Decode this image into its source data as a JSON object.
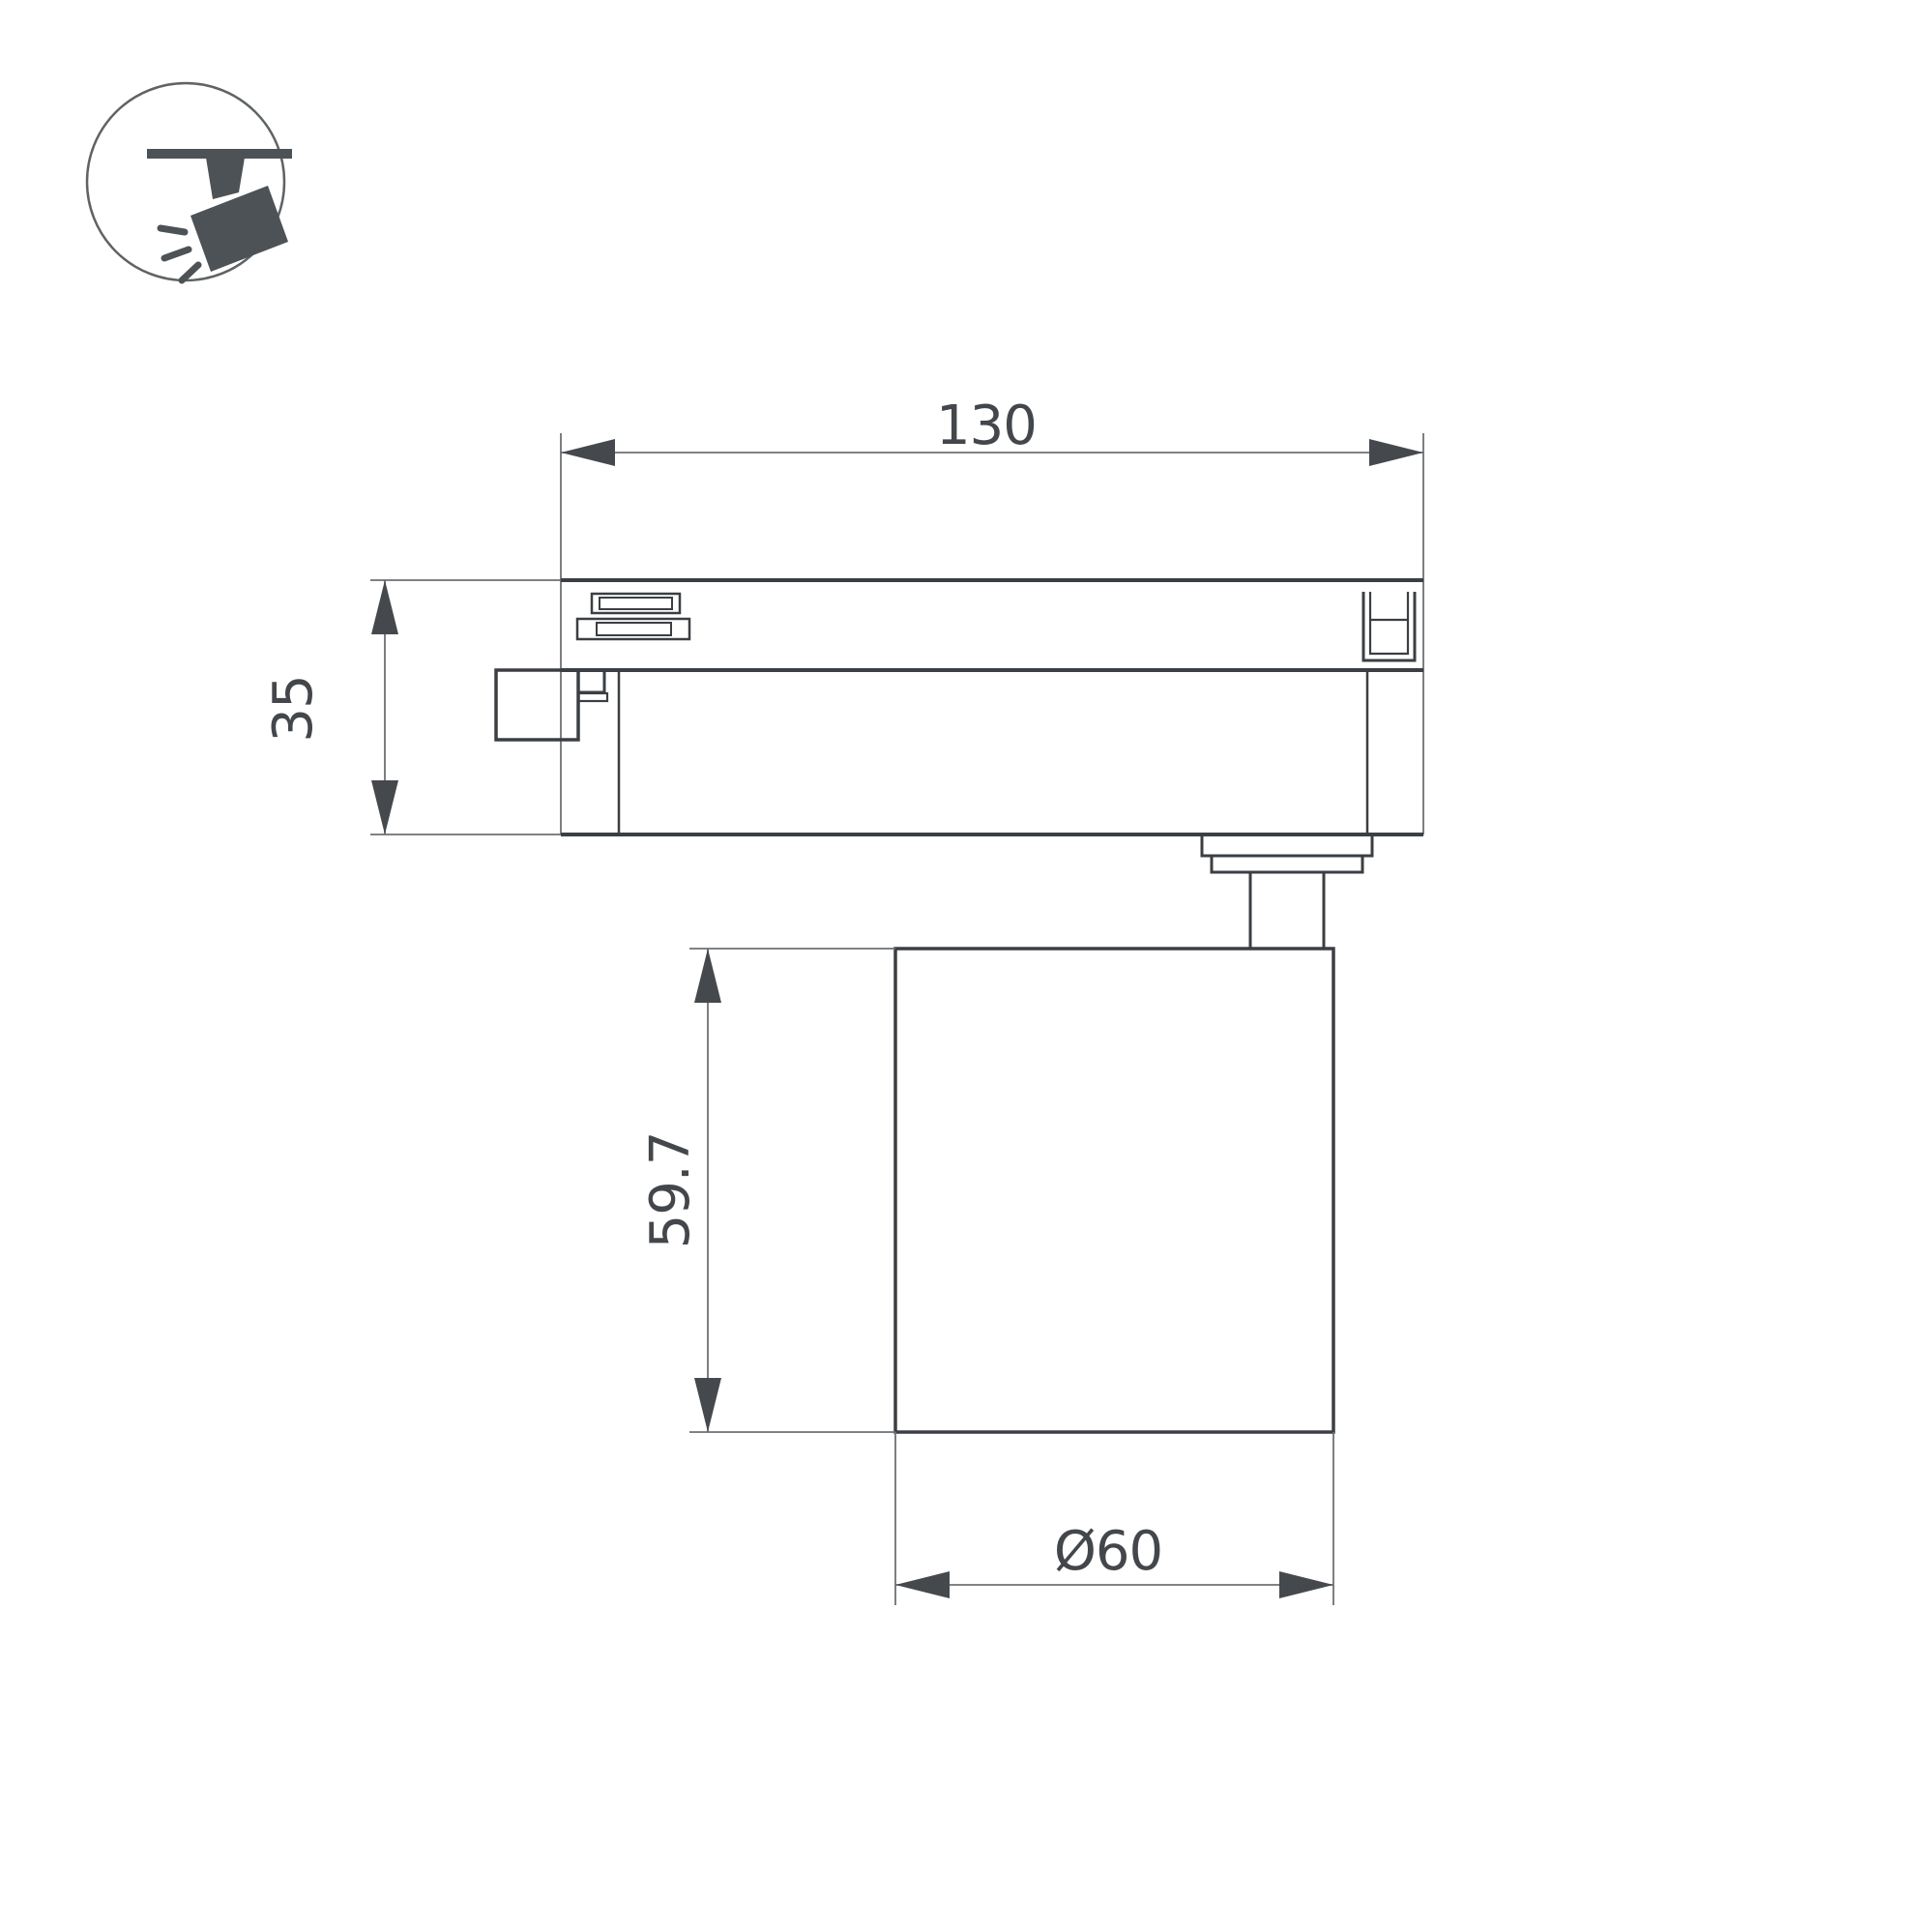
{
  "colors": {
    "line-strong": "#3b3f43",
    "line-thin": "#6d7174",
    "arrow": "#45494d",
    "text": "#43474b",
    "icon-fill": "#4d5257",
    "icon-ring": "#5f6366",
    "bg": "#ffffff"
  },
  "icon": {
    "name": "track-spotlight-icon",
    "description": "ceiling track with tilted spotlight head emitting rays"
  },
  "drawing": {
    "type": "technical-dimension-drawing",
    "view": "side view of track light fixture"
  },
  "dimensions": {
    "width": {
      "label": "130",
      "value": 130,
      "axis": "horizontal"
    },
    "track_height": {
      "label": "35",
      "value": 35,
      "axis": "vertical"
    },
    "body_height": {
      "label": "59.7",
      "value": 59.7,
      "axis": "vertical"
    },
    "diameter": {
      "label": "Ø60",
      "value": 60,
      "axis": "horizontal"
    }
  }
}
